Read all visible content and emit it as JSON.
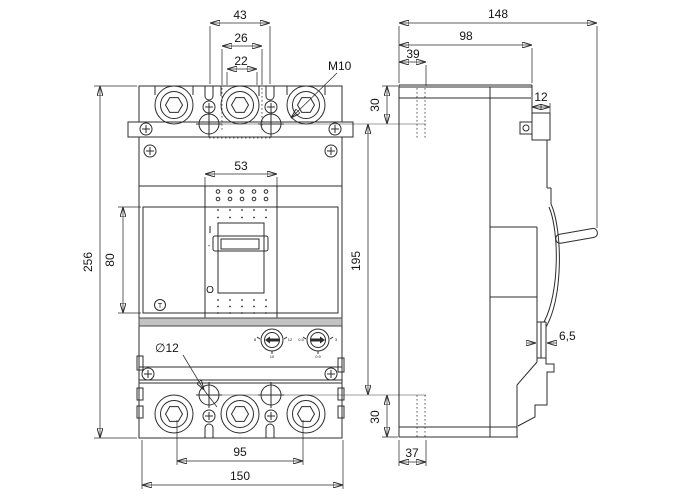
{
  "front": {
    "dims": {
      "d43": "43",
      "d26": "26",
      "d22": "22",
      "thread": "M10",
      "d53": "53",
      "d256": "256",
      "d80": "80",
      "hole": "∅12",
      "d95": "95",
      "d150": "150"
    },
    "markings": {
      "on": "I",
      "dash": "-",
      "off": "O",
      "test": "T"
    },
    "dial_left": {
      "left": "8",
      "right": "12",
      "bottom": "10"
    },
    "dial_right": {
      "left": "0.5",
      "right": "3",
      "bottom": "0.9"
    }
  },
  "side": {
    "dims": {
      "d148": "148",
      "d98": "98",
      "d39": "39",
      "d30_top": "30",
      "d12": "12",
      "d195": "195",
      "d6_5": "6,5",
      "d30_bottom": "30",
      "d37": "37"
    }
  },
  "line_color": "#2c2c2c",
  "band_color": "#c3c3c3"
}
